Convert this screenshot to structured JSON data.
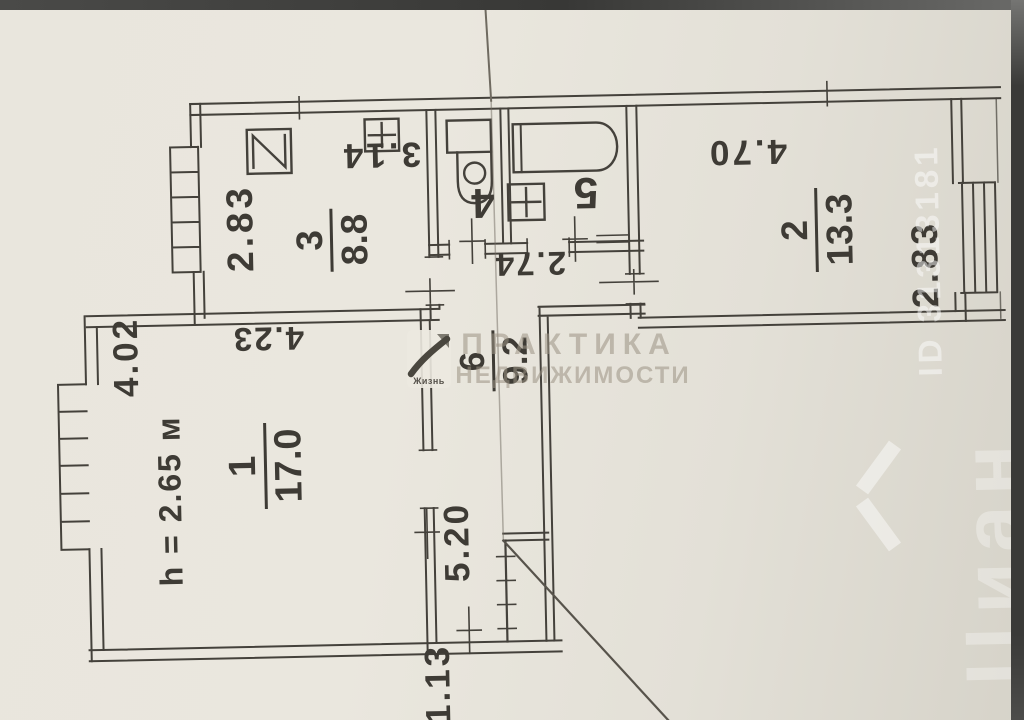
{
  "document_type": "apartment floor plan scan",
  "plan": {
    "rooms": {
      "room1": {
        "number": "1",
        "area": "17.0"
      },
      "room2": {
        "number": "2",
        "area": "13.3"
      },
      "room3": {
        "number": "3",
        "area": "8.8"
      },
      "room4": {
        "number": "4"
      },
      "room5": {
        "number": "5"
      },
      "room6": {
        "number": "6",
        "area": "9.2"
      }
    },
    "dimensions": {
      "room3_width": "2.83",
      "room3_length": "3.14",
      "wc_bath_width": "2.74",
      "room2_length": "4.70",
      "room2_width": "2.83",
      "room1_side": "4.02",
      "room1_length": "4.23",
      "ceiling_height": "h = 2.65 м",
      "hall_length": "5.20",
      "entry_width": "1.13"
    },
    "fixture_icons": [
      "sink-icon",
      "stove-icon",
      "toilet-icon",
      "bathtub-icon",
      "washbasin-icon",
      "closet-icon",
      "window-icon"
    ]
  },
  "watermarks": {
    "agency_line1": "ПРАКТИКА",
    "agency_line2": "НЕДВИЖИМОСТИ",
    "logo_text": "Жизнь",
    "portal_name": "Циан",
    "listing_id": "ID 31313181"
  },
  "colors": {
    "paper": "#e8e5dc",
    "ink": "#44413b",
    "watermark_gray": "#9c9384",
    "watermark_white": "rgba(255,255,255,0.45)",
    "photo_border": "#3a3a38"
  }
}
